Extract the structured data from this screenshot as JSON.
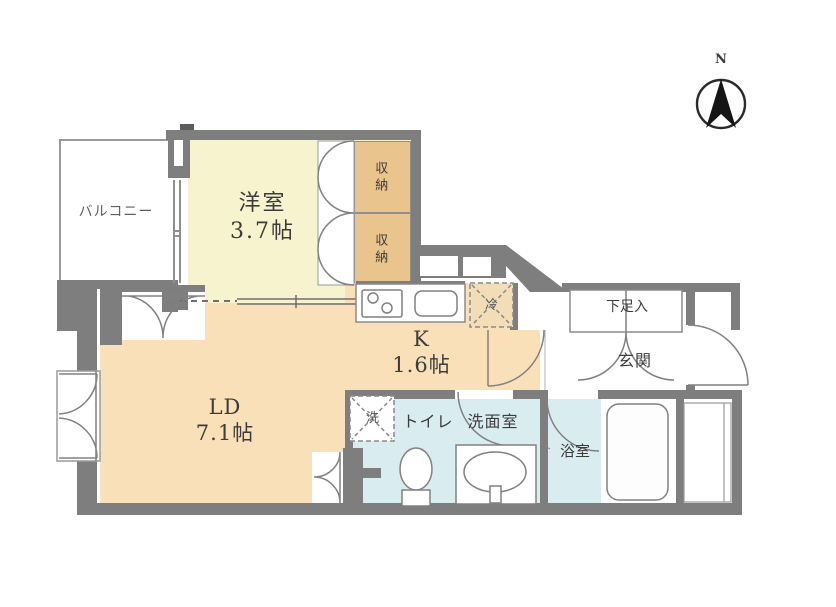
{
  "colors": {
    "wall": "#7e7e7e",
    "yellow": "#f7f3cf",
    "tan": "#e9c48d",
    "peach": "#f9e0b8",
    "blue": "#d9edf1",
    "line": "#818181",
    "text": "#3c3c3c"
  },
  "compass": {
    "label": "N"
  },
  "rooms": {
    "balcony": {
      "label": "バルコニー"
    },
    "western": {
      "label": "洋室",
      "size": "3.7帖"
    },
    "closet_top": {
      "label": "収納"
    },
    "closet_bottom": {
      "label": "収納"
    },
    "kitchen": {
      "label": "K",
      "size": "1.6帖"
    },
    "ld": {
      "label": "LD",
      "size": "7.1帖"
    },
    "toilet": {
      "label": "トイレ"
    },
    "washroom": {
      "label": "洗面室"
    },
    "bathroom": {
      "label": "浴室"
    },
    "entrance": {
      "label": "玄関"
    },
    "shoe": {
      "label": "下足入"
    }
  },
  "fixtures": {
    "fridge": {
      "label": "冷"
    },
    "washer": {
      "label": "洗"
    }
  }
}
